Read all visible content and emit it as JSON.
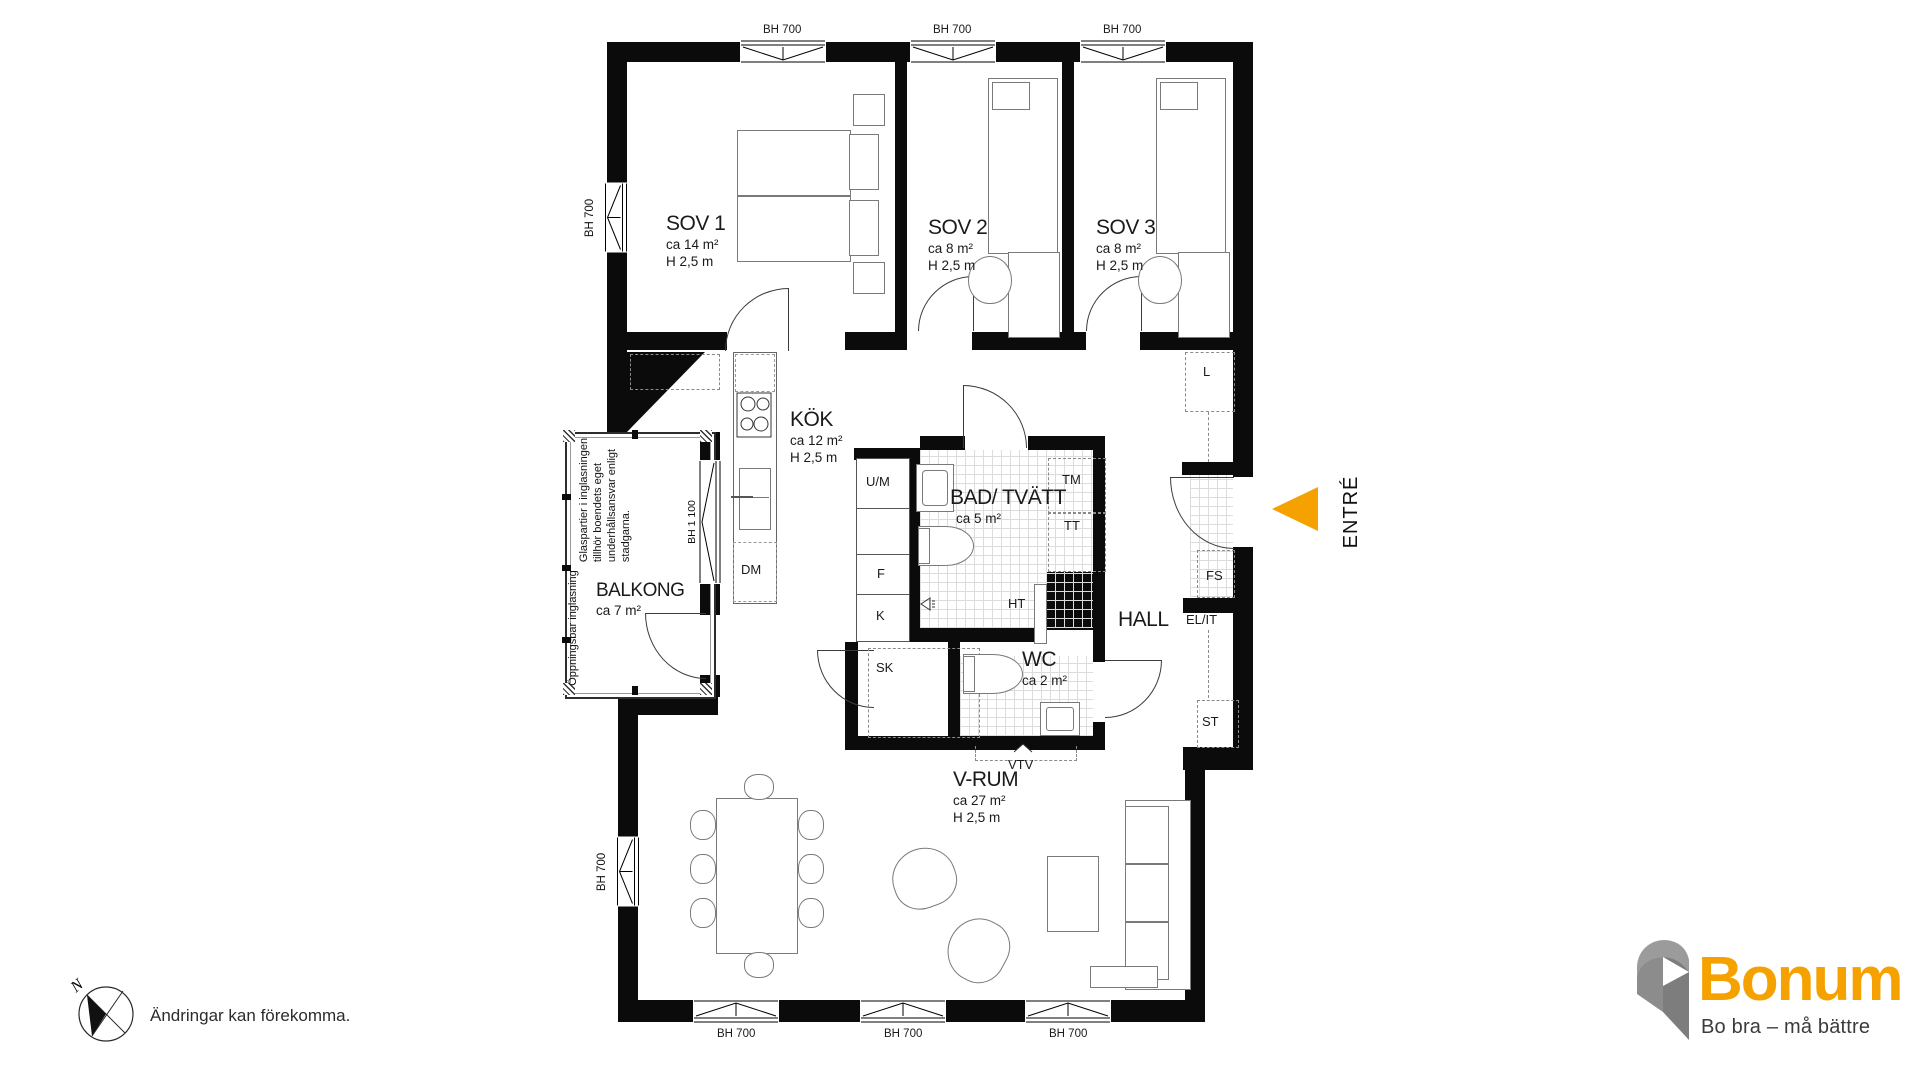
{
  "plan": {
    "rooms": {
      "sov1": {
        "name": "SOV 1",
        "area": "ca 14 m²",
        "height": "H 2,5 m"
      },
      "sov2": {
        "name": "SOV 2",
        "area": "ca 8 m²",
        "height": "H 2,5 m"
      },
      "sov3": {
        "name": "SOV 3",
        "area": "ca 8 m²",
        "height": "H 2,5 m"
      },
      "kok": {
        "name": "KÖK",
        "area": "ca 12 m²",
        "height": "H 2,5 m"
      },
      "bad": {
        "name": "BAD/ TVÄTT",
        "area": "ca 5 m²"
      },
      "wc": {
        "name": "WC",
        "area": "ca 2 m²"
      },
      "vrum": {
        "name": "V-RUM",
        "area": "ca 27 m²",
        "height": "H 2,5 m"
      },
      "hall": {
        "name": "HALL"
      },
      "balkong": {
        "name": "BALKONG",
        "area": "ca 7 m²"
      }
    },
    "fixtures": {
      "um": "U/M",
      "f": "F",
      "k": "K",
      "dm": "DM",
      "tm": "TM",
      "tt": "TT",
      "ht": "HT",
      "sk": "SK",
      "l": "L",
      "fs": "FS",
      "elit": "EL/IT",
      "st": "ST",
      "vtv": "VTV"
    },
    "windows": {
      "bh700": "BH 700",
      "bh1100": "BH 1 100"
    },
    "entry_label": "ENTRÉ",
    "balcony_notes": {
      "glass_line1": "Glaspartier i inglasningen",
      "glass_line2": "tillhör boendets eget",
      "glass_line3": "underhållsansvar enligt",
      "glass_line4": "stadgarna.",
      "openable": "Öppningsbar inglasning"
    }
  },
  "footer": {
    "north": "N",
    "disclaimer": "Ändringar kan förekomma."
  },
  "brand": {
    "name": "Bonum",
    "tagline": "Bo bra – må bättre",
    "orange": "#f5a200",
    "gray": "#8c8c8c"
  }
}
